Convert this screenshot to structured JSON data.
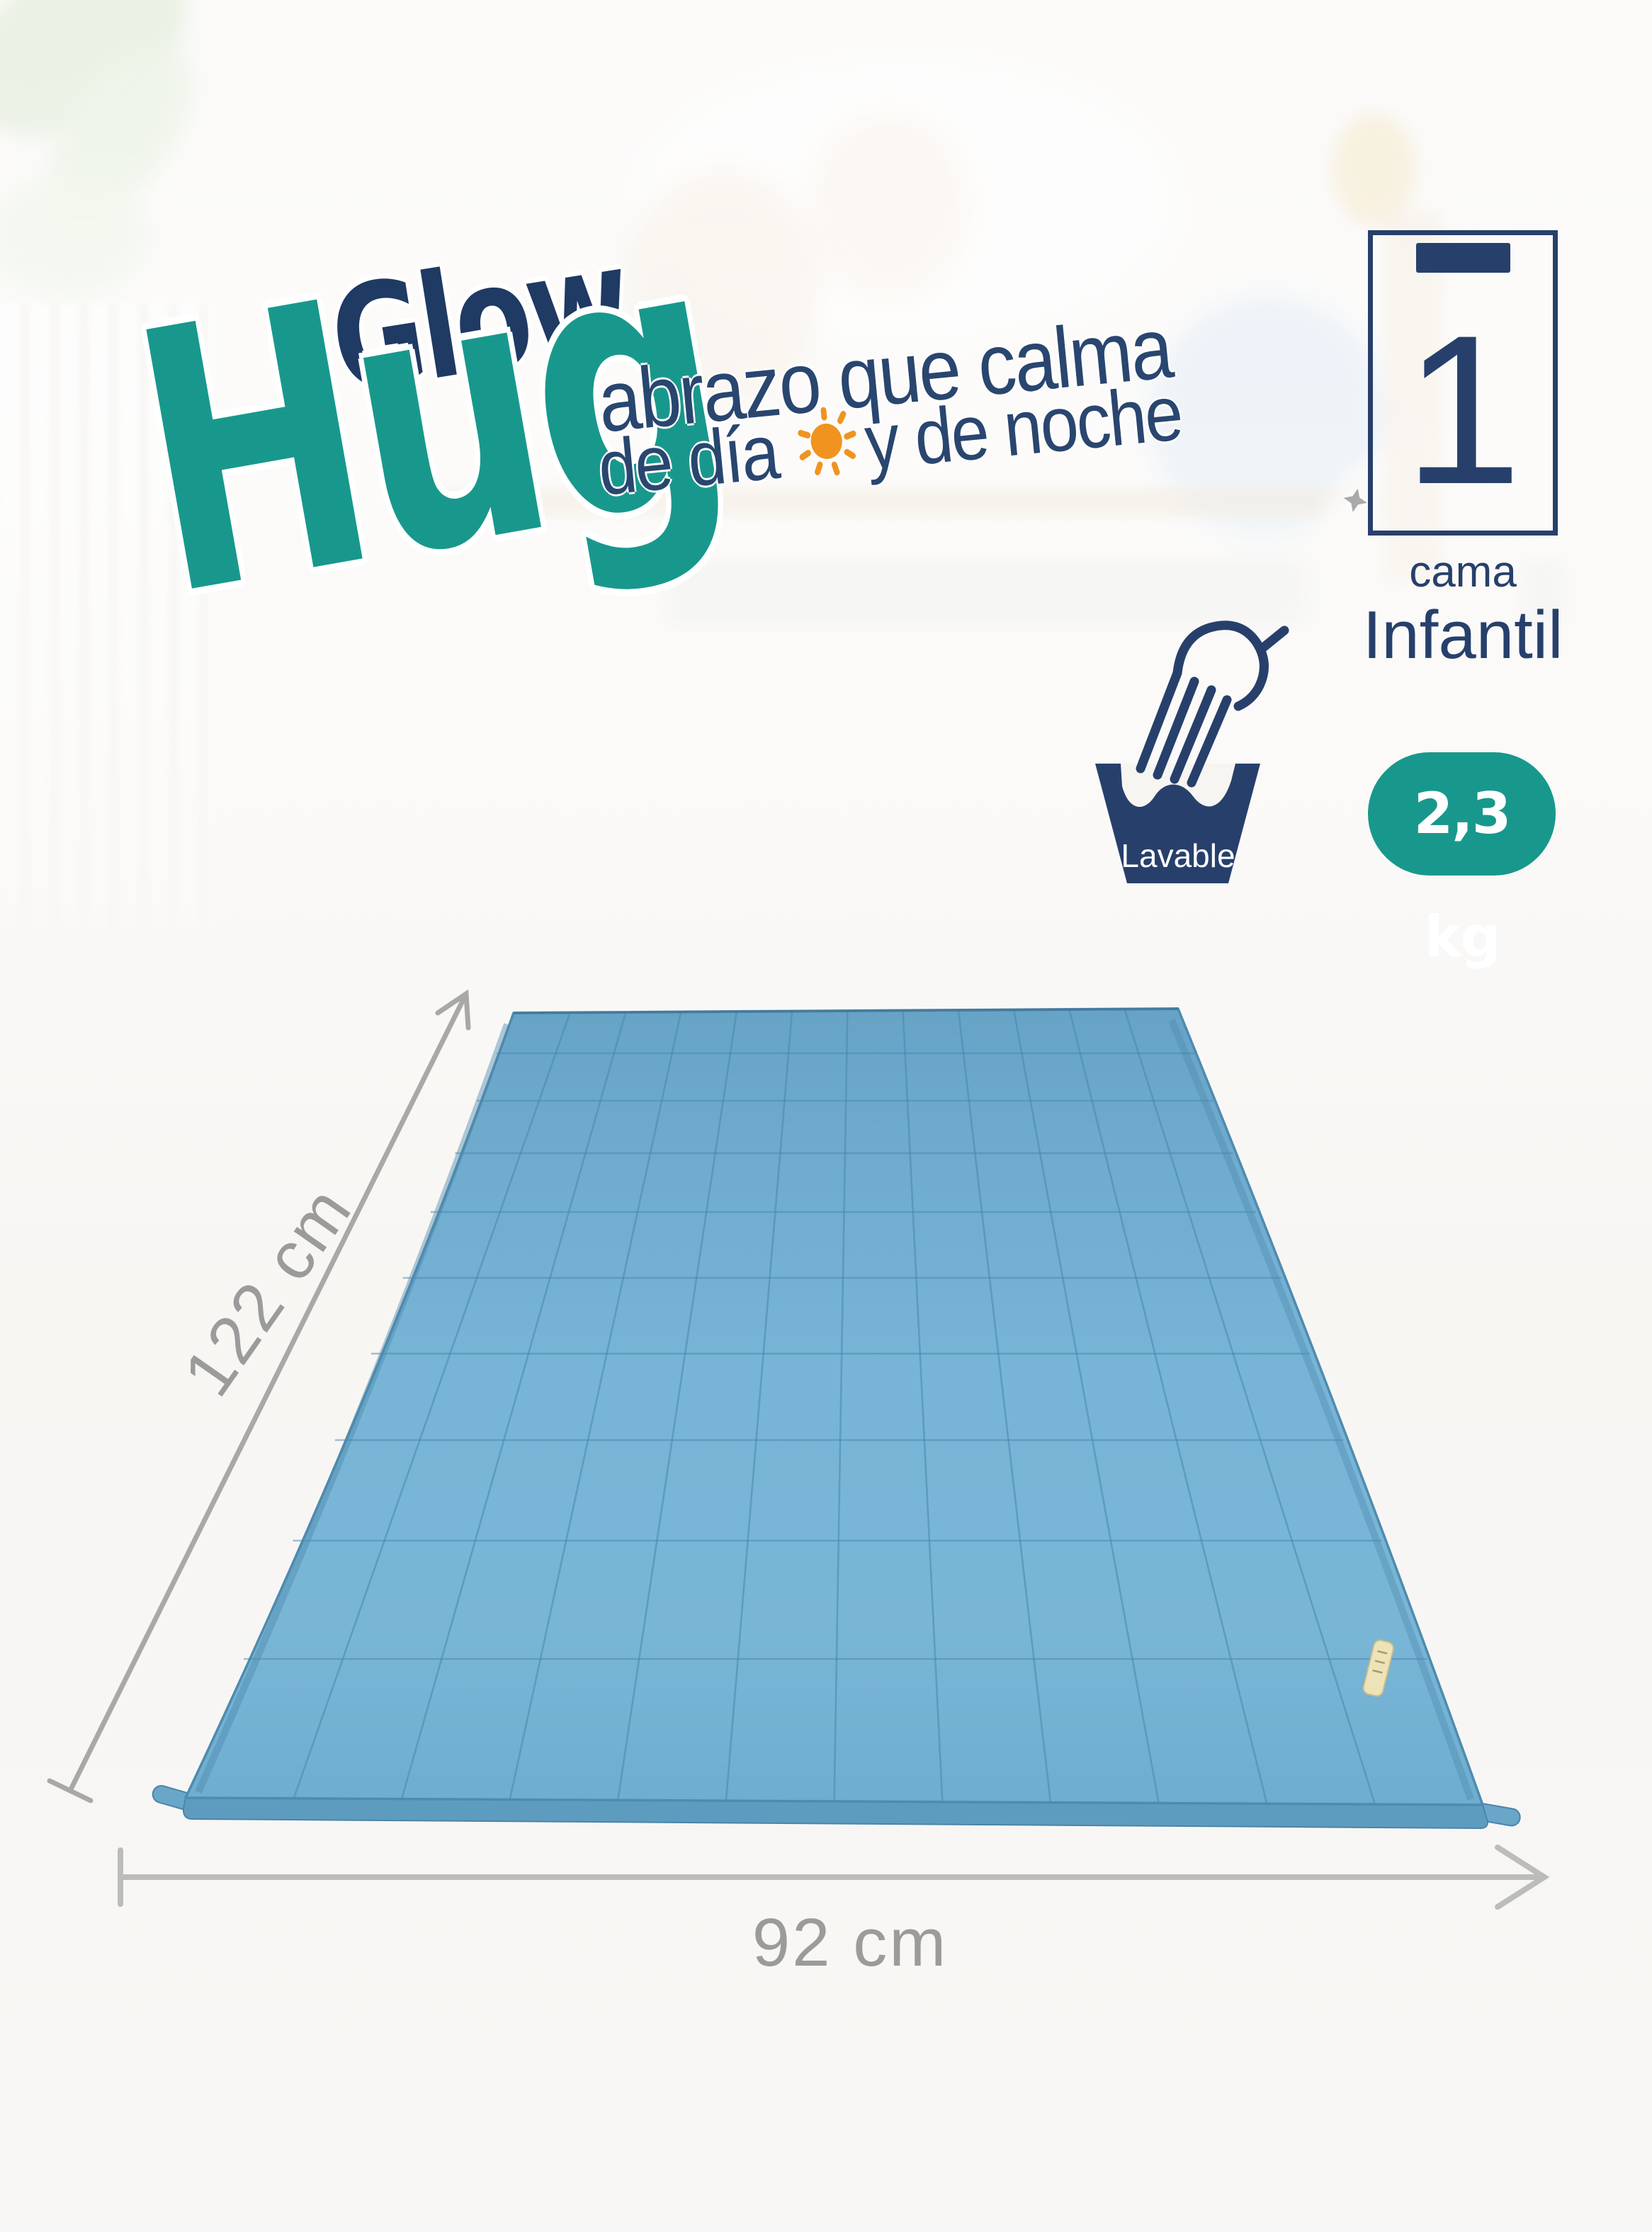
{
  "brand": {
    "word1": "Glow",
    "word2": "Hug"
  },
  "tagline": {
    "line1": "abrazo que calma",
    "line2_part1": "de día",
    "line2_part2": "y de noche"
  },
  "bed_badge": {
    "count": "1",
    "label_small": "cama",
    "label_big": "Infantil"
  },
  "features": {
    "washable_label": "Lavable",
    "weight_badge": "2,3 kg"
  },
  "dimensions": {
    "length": "122 cm",
    "width": "92 cm"
  },
  "colors": {
    "teal": "#18988C",
    "navy": "#27406B",
    "logo_navy": "#1F3A63",
    "orange": "#F0941F",
    "dim_gray": "#9B9B9B",
    "mat_blue": "#72AFD0",
    "mat_line": "#4886AD"
  }
}
